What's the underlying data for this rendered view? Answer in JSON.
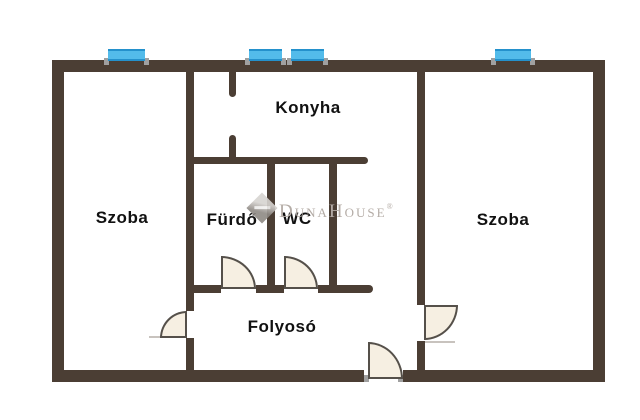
{
  "plan": {
    "background": "#ffffff",
    "wall_color": "#4b3e34",
    "window_color": "#53bbea",
    "window_frame_color": "#2491cc",
    "door_fill": "#f6efe2",
    "door_stroke": "#55504a",
    "label_color": "#111111",
    "watermark_color": "#b4aca6"
  },
  "rooms": {
    "szoba_left": "Szoba",
    "konyha": "Konyha",
    "furdo": "Fürdő",
    "wc": "WC",
    "szoba_right": "Szoba",
    "folyoso": "Folyosó"
  },
  "watermark": {
    "brand_part1": "Duna",
    "brand_part2": "House",
    "registered_mark": "®",
    "logo": "dunahouse-diamond-logo"
  },
  "counts": {
    "windows": 4,
    "doors": 5
  }
}
